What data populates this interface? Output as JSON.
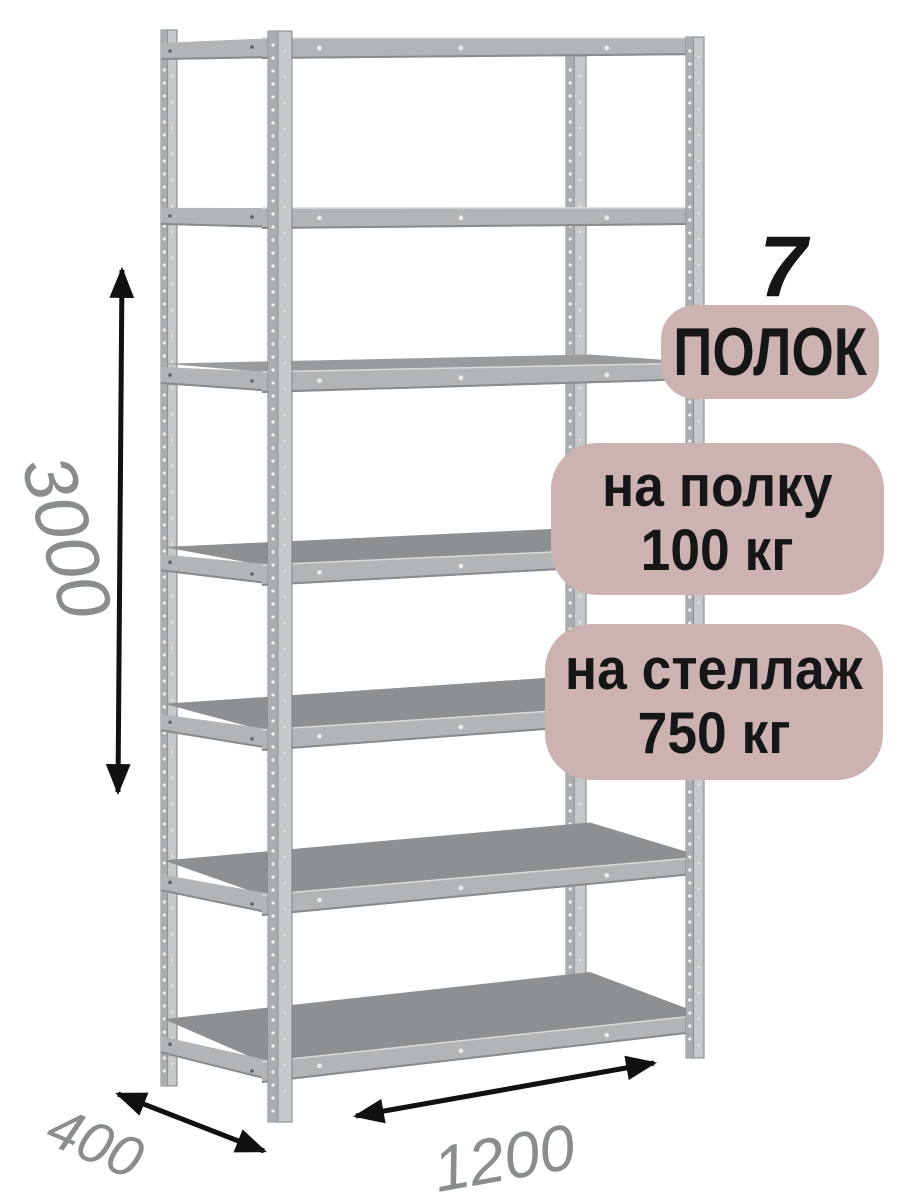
{
  "meta": {
    "description": "Карточка товара: металлический стеллаж с размерами"
  },
  "rack": {
    "shelf_count": 7,
    "colors": {
      "post_face": "#c6c9cb",
      "post_flange": "#aaadaf",
      "edge": "#7f8486",
      "shelf_top": "#8c9093",
      "shelf_top_light": "#989c9f",
      "band": "#b1b5b7",
      "band_shadow": "#878b8e",
      "band_highlight": "#d8dadb",
      "perforation": "#f1f2f2",
      "perforation_faint": "#dfe1e2",
      "rivet_light": "#e9ebeb",
      "rivet_dark": "#5f6365"
    }
  },
  "badges": {
    "bg_color": "#cdb2b2",
    "text_color": "#161616",
    "count_number": "7",
    "count_label": "ПОЛОК",
    "per_shelf": {
      "line1": "на полку",
      "line2": "100 кг"
    },
    "per_rack": {
      "line1": "на стеллаж",
      "line2": "750 кг"
    }
  },
  "dimensions": {
    "height_mm": "3000",
    "depth_mm": "400",
    "width_mm": "1200",
    "label_color": "#8a8d8d",
    "arrow_color": "#111111"
  }
}
